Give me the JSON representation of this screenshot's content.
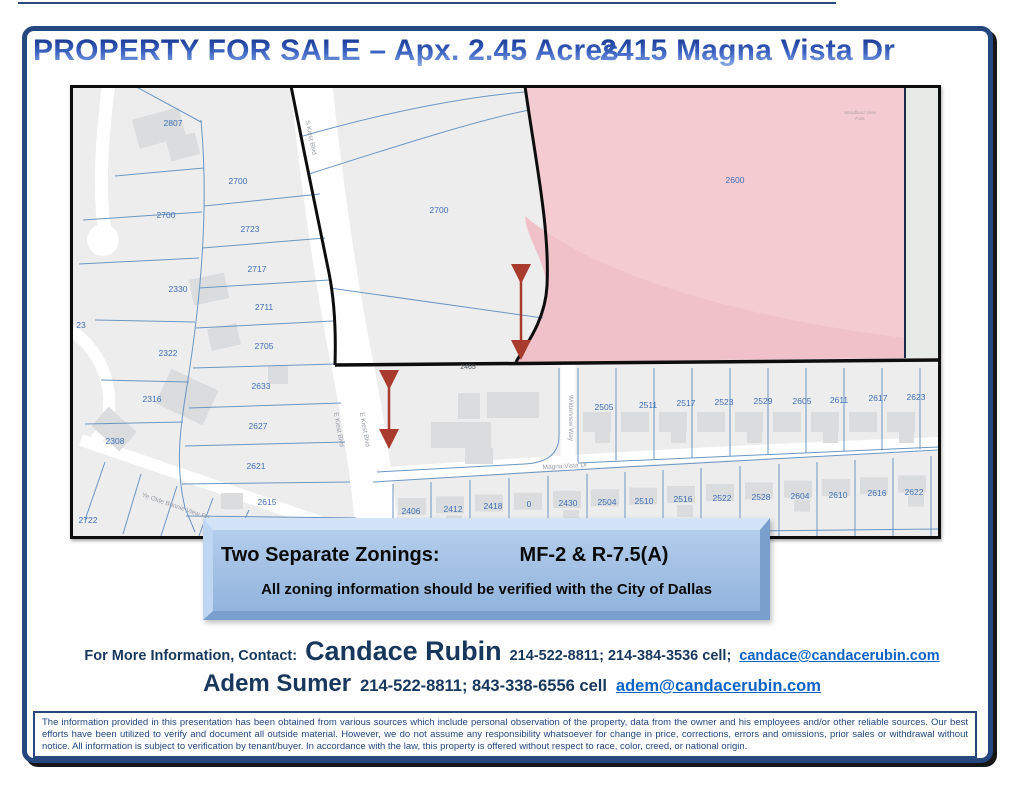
{
  "page": {
    "title_left": "PROPERTY FOR SALE – Apx. 2.45 Acres",
    "title_right": "2415 Magna Vista Dr"
  },
  "map": {
    "highlight_parcel": "2600",
    "parcel_labels": [
      {
        "t": "2807",
        "x": 100,
        "y": 38
      },
      {
        "t": "2700",
        "x": 165,
        "y": 96
      },
      {
        "t": "2700",
        "x": 93,
        "y": 130
      },
      {
        "t": "2723",
        "x": 177,
        "y": 144
      },
      {
        "t": "2717",
        "x": 184,
        "y": 184
      },
      {
        "t": "2711",
        "x": 191,
        "y": 222
      },
      {
        "t": "2330",
        "x": 105,
        "y": 204
      },
      {
        "t": "23",
        "x": 8,
        "y": 240
      },
      {
        "t": "2322",
        "x": 95,
        "y": 268
      },
      {
        "t": "2705",
        "x": 191,
        "y": 261
      },
      {
        "t": "2633",
        "x": 188,
        "y": 301
      },
      {
        "t": "2316",
        "x": 79,
        "y": 314
      },
      {
        "t": "2627",
        "x": 185,
        "y": 341
      },
      {
        "t": "2308",
        "x": 42,
        "y": 356
      },
      {
        "t": "2621",
        "x": 183,
        "y": 381
      },
      {
        "t": "2615",
        "x": 194,
        "y": 417
      },
      {
        "t": "2722",
        "x": 15,
        "y": 435
      },
      {
        "t": "2700",
        "x": 366,
        "y": 125
      },
      {
        "t": "2600",
        "x": 662,
        "y": 95
      },
      {
        "t": "2505",
        "x": 531,
        "y": 322
      },
      {
        "t": "2511",
        "x": 575,
        "y": 320
      },
      {
        "t": "2517",
        "x": 613,
        "y": 318
      },
      {
        "t": "2523",
        "x": 651,
        "y": 317
      },
      {
        "t": "2529",
        "x": 690,
        "y": 316
      },
      {
        "t": "2605",
        "x": 729,
        "y": 316
      },
      {
        "t": "2611",
        "x": 766,
        "y": 315
      },
      {
        "t": "2617",
        "x": 805,
        "y": 313
      },
      {
        "t": "2623",
        "x": 843,
        "y": 312
      },
      {
        "t": "2406",
        "x": 338,
        "y": 426
      },
      {
        "t": "2412",
        "x": 380,
        "y": 424
      },
      {
        "t": "2418",
        "x": 420,
        "y": 421
      },
      {
        "t": "0",
        "x": 456,
        "y": 419
      },
      {
        "t": "2430",
        "x": 495,
        "y": 418
      },
      {
        "t": "2504",
        "x": 534,
        "y": 417
      },
      {
        "t": "2510",
        "x": 571,
        "y": 416
      },
      {
        "t": "2516",
        "x": 610,
        "y": 414
      },
      {
        "t": "2522",
        "x": 649,
        "y": 413
      },
      {
        "t": "2528",
        "x": 688,
        "y": 412
      },
      {
        "t": "2604",
        "x": 727,
        "y": 411
      },
      {
        "t": "2610",
        "x": 765,
        "y": 410
      },
      {
        "t": "2616",
        "x": 804,
        "y": 408
      },
      {
        "t": "2622",
        "x": 841,
        "y": 407
      }
    ],
    "street_labels": [
      {
        "t": "S Kiest Blvd",
        "x": 236,
        "y": 50,
        "r": 78
      },
      {
        "t": "E Kiest Blvd",
        "x": 264,
        "y": 342,
        "r": 80
      },
      {
        "t": "E Kiest Blvd",
        "x": 290,
        "y": 342,
        "r": 80
      },
      {
        "t": "Wilderview Way",
        "x": 496,
        "y": 330,
        "r": 90
      },
      {
        "t": "Magna Vista Dr",
        "x": 492,
        "y": 380,
        "r": -3
      },
      {
        "t": "Ye Olde Bonnie View Rd",
        "x": 102,
        "y": 420,
        "r": 19
      }
    ],
    "boundary_label": {
      "t": "2465",
      "x": 395,
      "y": 281
    },
    "park_label": {
      "lines": [
        "Woodland View",
        "Park"
      ],
      "x": 787,
      "y": 26
    },
    "colors": {
      "highlight_fill": "#f4cbd1",
      "highlight_fill_dark": "#f0c1c9",
      "parcel_line": "#6b96c4",
      "parcel_number": "#3f6fb5",
      "boundary_black": "#0d0d0d",
      "arrow_red": "#a93a2e",
      "park_strip": "#e7ebe7"
    }
  },
  "banner": {
    "line1_label": "Two Separate Zonings:",
    "line1_value": "MF-2 & R-7.5(A)",
    "line2": "All zoning information should be verified with the City of Dallas"
  },
  "contact": {
    "prefix": "For More Information, Contact:",
    "agent1": {
      "name": "Candace Rubin",
      "phones": "214-522-8811; 214-384-3536 cell;",
      "email": "candace@candacerubin.com"
    },
    "agent2": {
      "name": "Adem Sumer",
      "phones": "214-522-8811; 843-338-6556 cell",
      "email": "adem@candacerubin.com"
    }
  },
  "disclaimer": {
    "text": "The information provided in this presentation has been obtained from various sources which include personal observation of the property, data from the owner and his employees and/or other reliable sources.  Our best efforts have been utilized to verify and document all outside material.  However, we do not assume any responsibility whatsoever for change in price, corrections, errors and omissions, prior sales or withdrawal without notice.  All information is subject to verification by tenant/buyer. In accordance with the law, this property is offered without respect to race, color, creed, or national origin."
  },
  "theme_colors": {
    "title_blue": "#2d53b5",
    "navy_text": "#17375d",
    "link_blue": "#0d63c5",
    "border_navy": "#24477f",
    "banner_face": "#a3c0e4"
  }
}
